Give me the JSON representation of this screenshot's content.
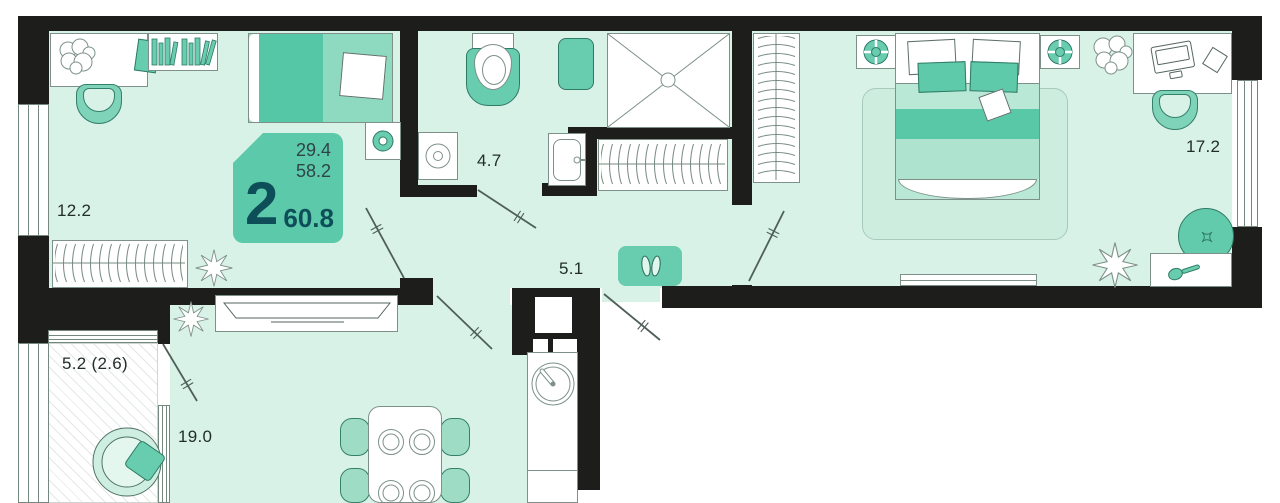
{
  "floor_plan": {
    "badge": {
      "rooms_count": "2",
      "area_top": "29.4",
      "area_middle": "58.2",
      "area_total": "60.8"
    },
    "room_labels": {
      "room1": "12.2",
      "bathroom": "4.7",
      "hallway": "5.1",
      "bedroom": "17.2",
      "balcony": "5.2 (2.6)",
      "living": "19.0"
    },
    "colors": {
      "wall": "#1d1d1b",
      "floor": "#d8f2e8",
      "accent_teal": "#68ccae",
      "accent_teal_dark": "#2f7a64",
      "badge_fill": "#5dc9ab",
      "badge_text": "#0e4e59",
      "label_text": "#222e2a",
      "outline_gray": "#7d918a"
    },
    "icons": [
      "desk",
      "bookshelf",
      "office-chair",
      "single-bed",
      "double-bed",
      "wardrobe-hangers",
      "coat-rack",
      "plant",
      "toilet",
      "shower",
      "washing-machine",
      "bath-sink",
      "bath-rug",
      "shoe-mat",
      "tv-console",
      "dining-table",
      "kitchen-sink",
      "nightstand-lamp",
      "pouf",
      "dressing-table",
      "balcony-chair",
      "radiator",
      "door-leaf"
    ]
  }
}
